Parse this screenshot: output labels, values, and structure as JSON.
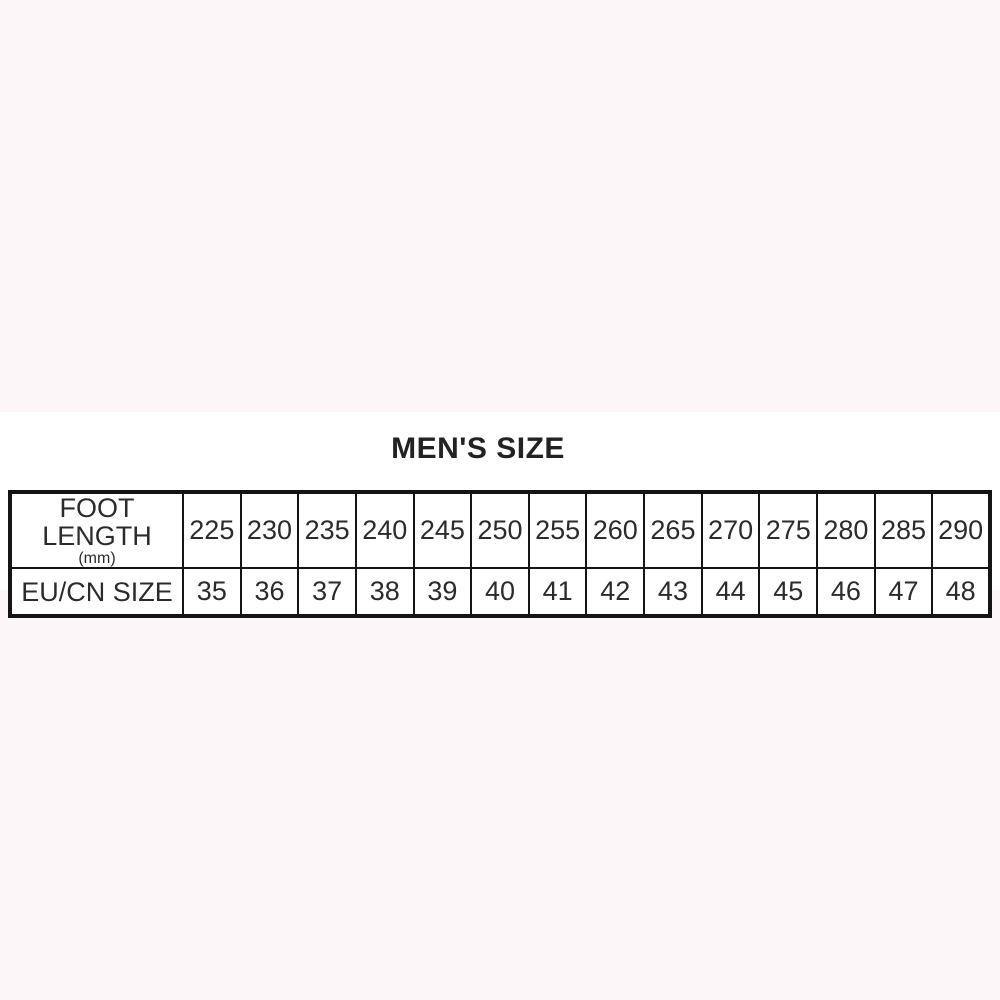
{
  "title": "MEN'S SIZE",
  "colors": {
    "page_background": "#FDF6F8",
    "band_background": "#FFFFFF",
    "table_border": "#141414",
    "text": "#2B2B2B"
  },
  "chart_data": {
    "type": "table",
    "title": "MEN'S SIZE",
    "row_headers": [
      "FOOT LENGTH (mm)",
      "EU/CN SIZE"
    ],
    "rows": [
      [
        "225",
        "230",
        "235",
        "240",
        "245",
        "250",
        "255",
        "260",
        "265",
        "270",
        "275",
        "280",
        "285",
        "290"
      ],
      [
        "35",
        "36",
        "37",
        "38",
        "39",
        "40",
        "41",
        "42",
        "43",
        "44",
        "45",
        "46",
        "47",
        "48"
      ]
    ]
  },
  "table": {
    "row1_label_line1": "FOOT LENGTH",
    "row1_label_line2": "(mm)",
    "row2_label": "EU/CN SIZE",
    "foot_length_mm": [
      "225",
      "230",
      "235",
      "240",
      "245",
      "250",
      "255",
      "260",
      "265",
      "270",
      "275",
      "280",
      "285",
      "290"
    ],
    "eu_cn_size": [
      "35",
      "36",
      "37",
      "38",
      "39",
      "40",
      "41",
      "42",
      "43",
      "44",
      "45",
      "46",
      "47",
      "48"
    ]
  }
}
